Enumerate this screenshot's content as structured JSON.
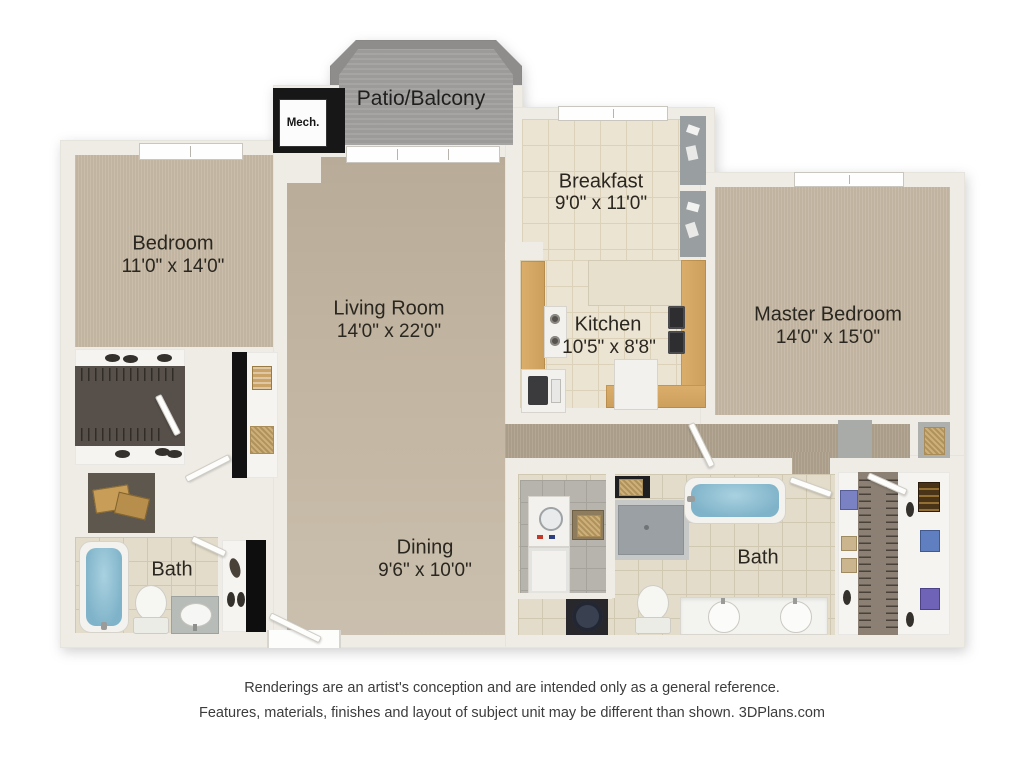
{
  "rooms": {
    "patio": {
      "name": "Patio/Balcony"
    },
    "mech": {
      "name": "Mech."
    },
    "bedroom": {
      "name": "Bedroom",
      "dims": "11'0\" x 14'0\""
    },
    "living_room": {
      "name": "Living Room",
      "dims": "14'0\" x 22'0\""
    },
    "breakfast": {
      "name": "Breakfast",
      "dims": "9'0\" x 11'0\""
    },
    "kitchen": {
      "name": "Kitchen",
      "dims": "10'5\" x 8'8\""
    },
    "master_bedroom": {
      "name": "Master Bedroom",
      "dims": "14'0\" x 15'0\""
    },
    "dining": {
      "name": "Dining",
      "dims": "9'6\" x 10'0\""
    },
    "bath_left": {
      "name": "Bath"
    },
    "bath_master": {
      "name": "Bath"
    }
  },
  "footer": {
    "line1": "Renderings are an artist's conception and are intended only as a general reference.",
    "line2": "Features, materials, finishes and layout of subject unit may be different than shown. 3DPlans.com"
  },
  "colors": {
    "wall": "#efece6",
    "carpet": "#c7baa6",
    "carpet_hall": "#b0a38f",
    "tile_kitchen": "#ece4d2",
    "tile_bath": "#e3dcca",
    "patio_concrete": "#a2a19f",
    "counter_wood": "#d3a262",
    "tub_blue": "#7fb3c9",
    "closet_floor": "#57504a",
    "label_text": "#2a2720"
  }
}
